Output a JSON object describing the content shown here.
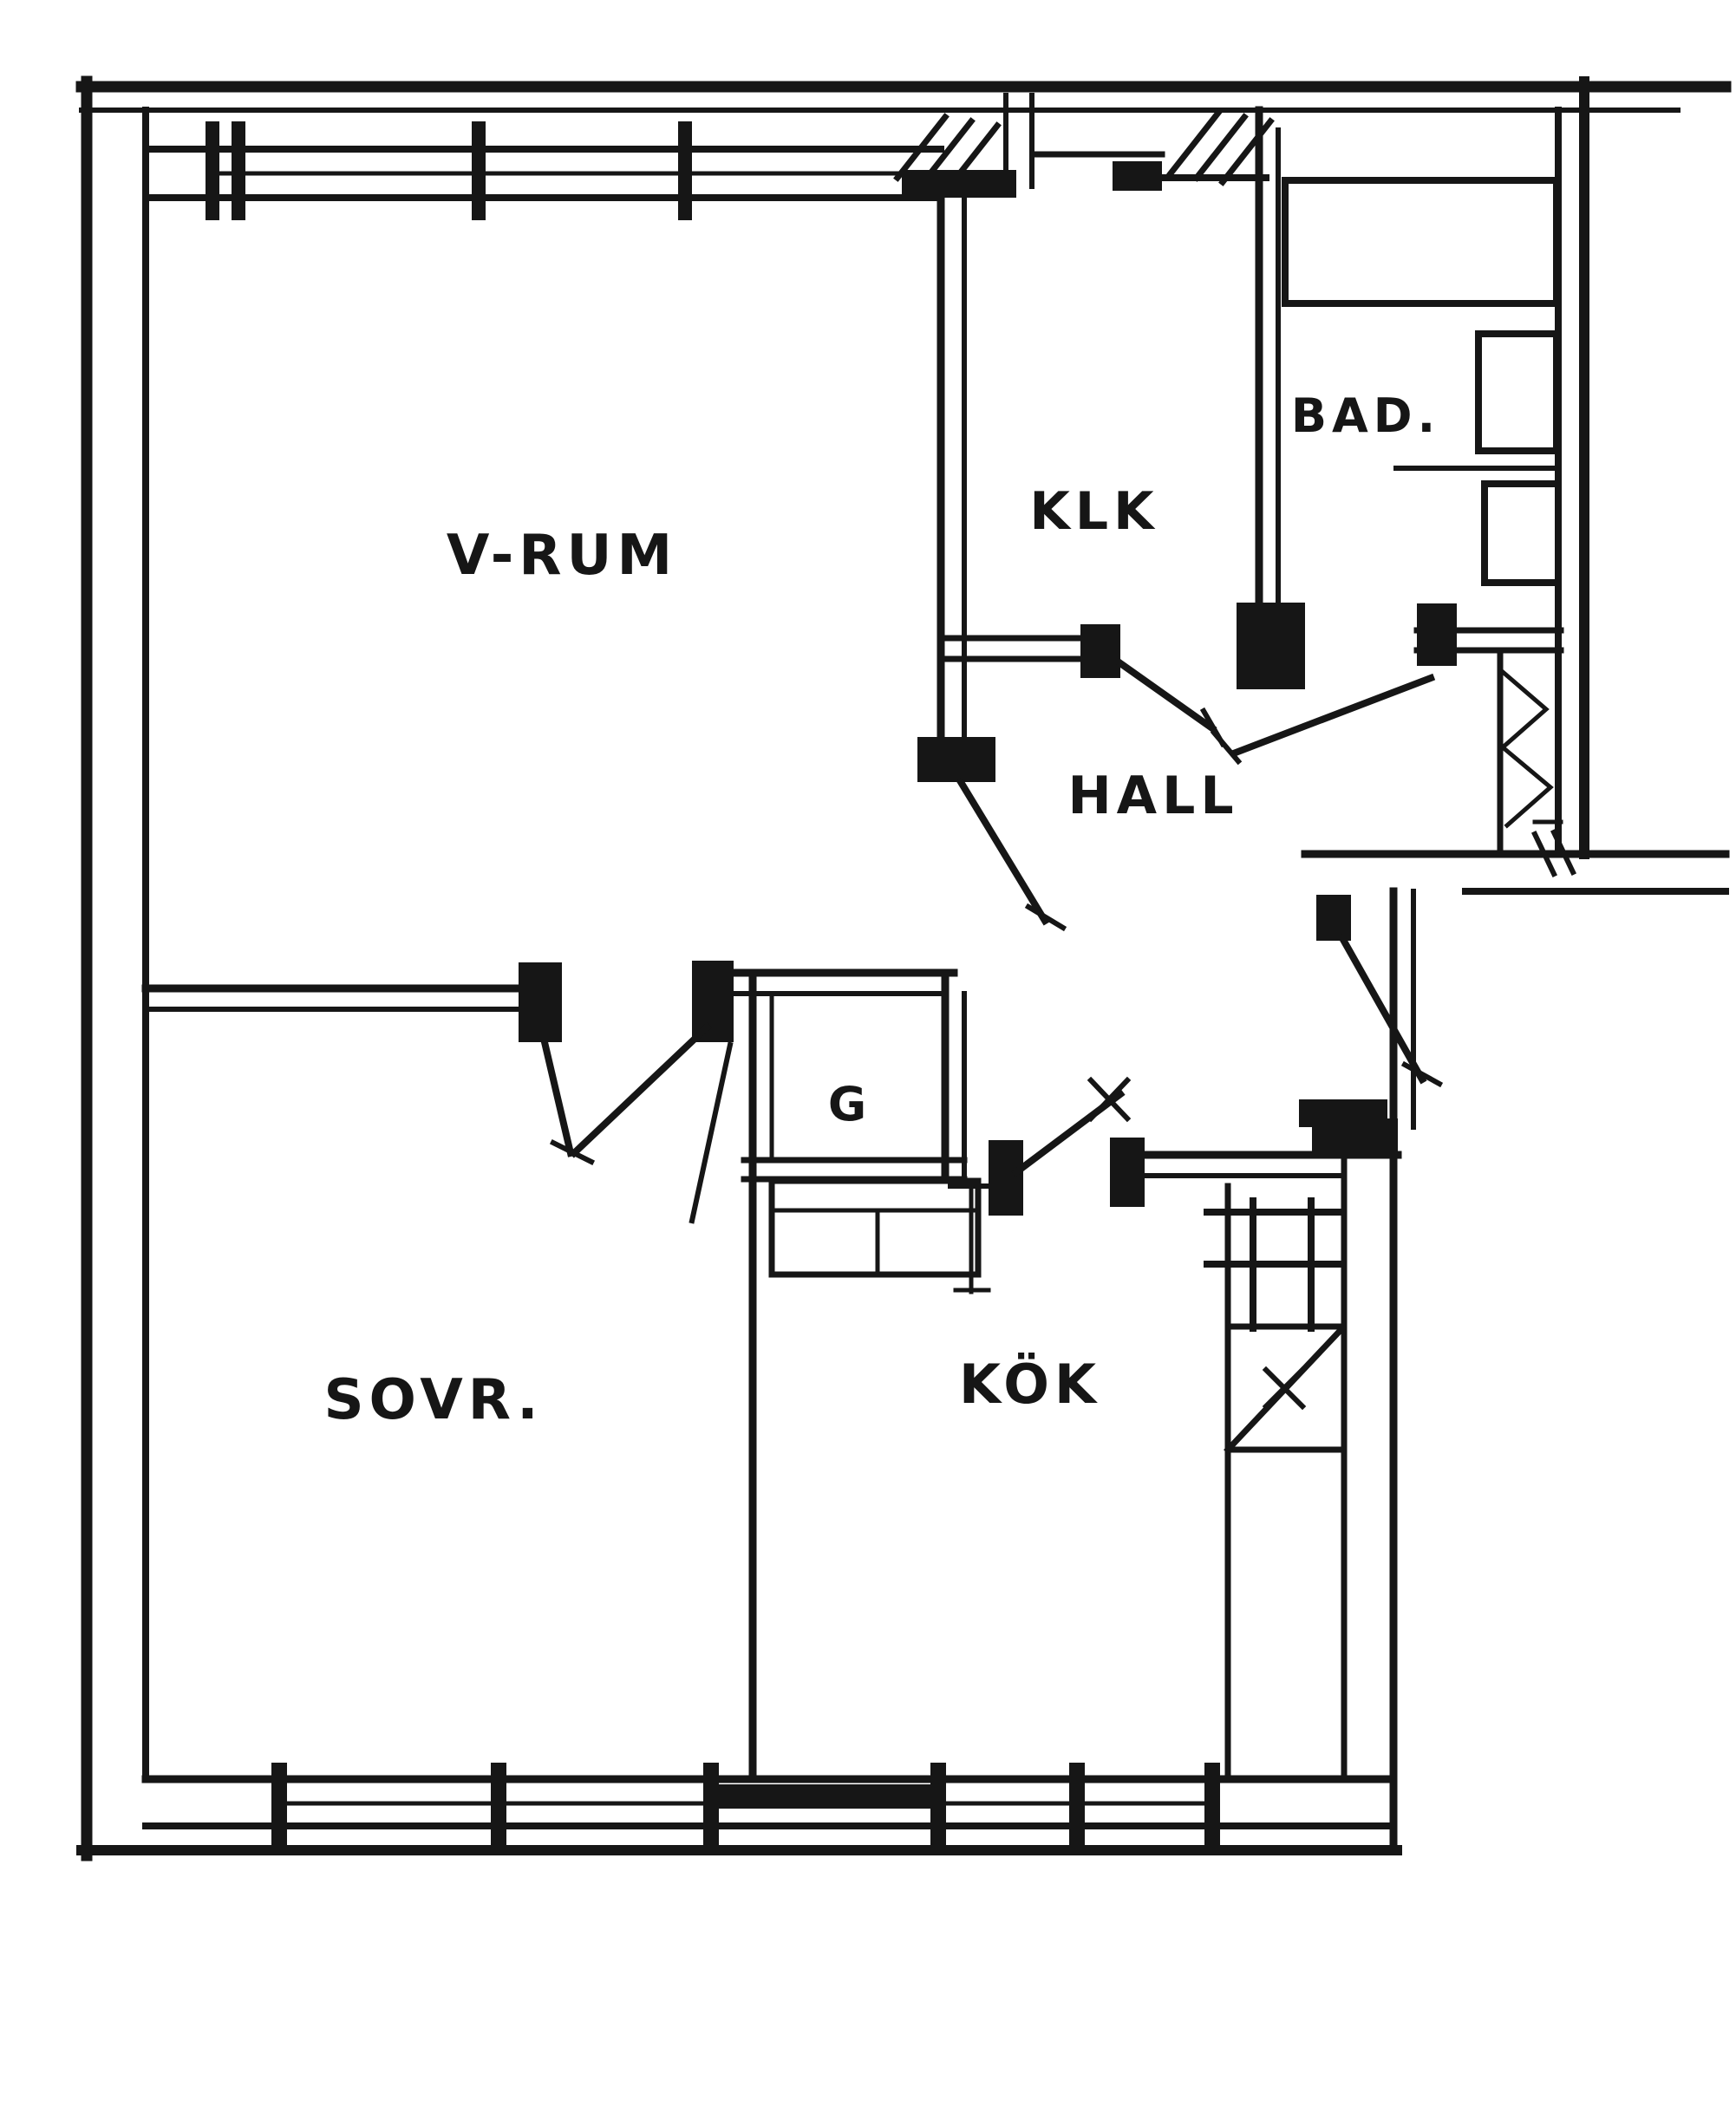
{
  "floor_plan": {
    "colors": {
      "ink": "#161616",
      "paper": "#ffffff"
    },
    "rooms": [
      {
        "id": "living-room",
        "label": "V-RUM"
      },
      {
        "id": "closet",
        "label": "KLK"
      },
      {
        "id": "bathroom",
        "label": "BAD."
      },
      {
        "id": "hall",
        "label": "HALL"
      },
      {
        "id": "wardrobe",
        "label": "G"
      },
      {
        "id": "bedroom",
        "label": "SOVR."
      },
      {
        "id": "kitchen",
        "label": "KÖK"
      }
    ]
  }
}
